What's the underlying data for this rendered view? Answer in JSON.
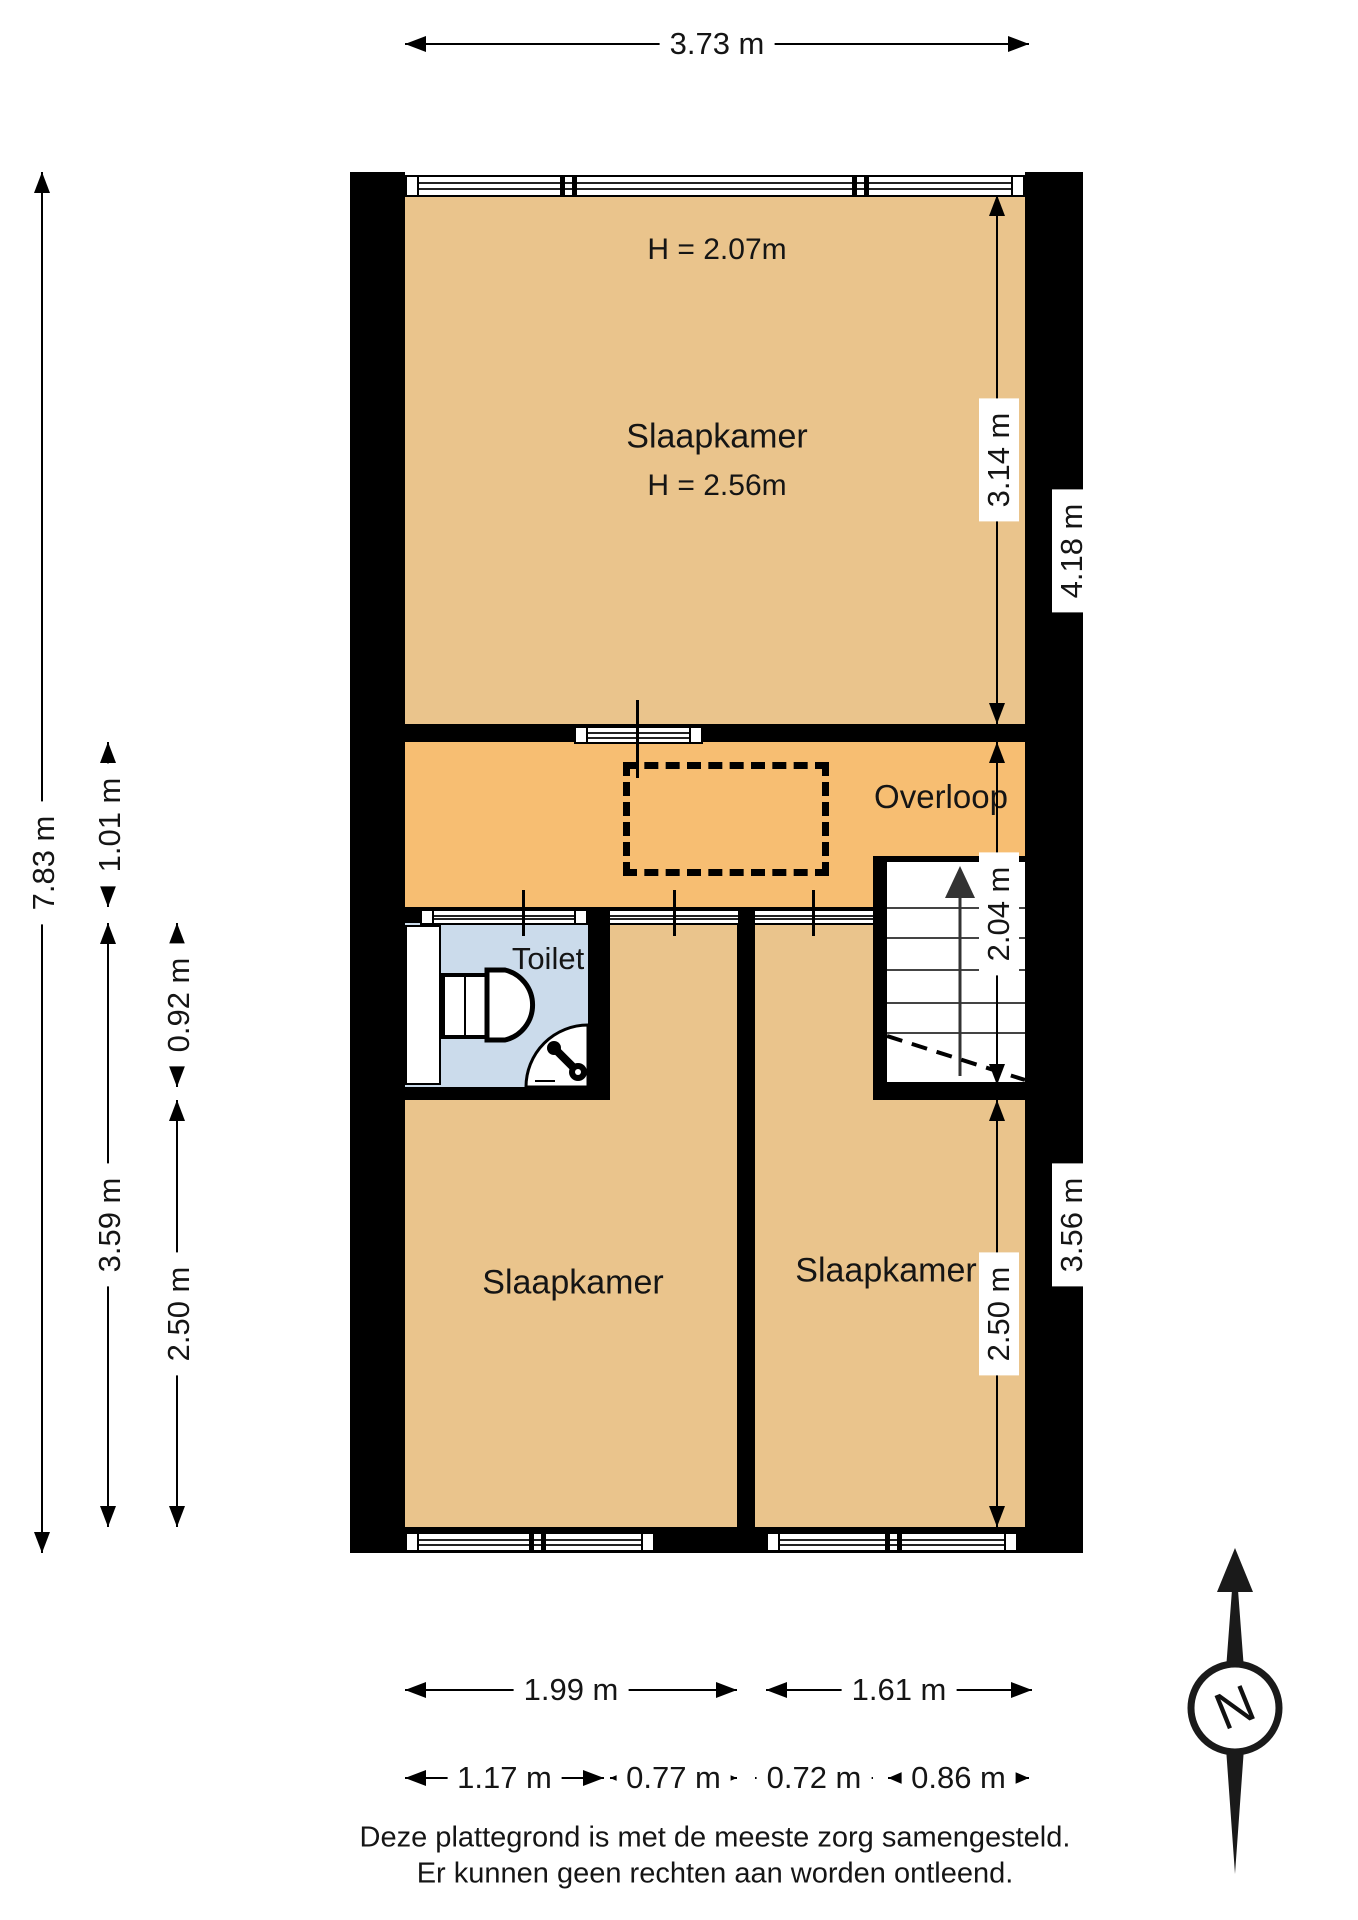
{
  "colors": {
    "room_fill": "#EAC48C",
    "landing_fill": "#F7BE72",
    "toilet_fill": "#CBDBEB",
    "wall": "#000000"
  },
  "rooms": {
    "bedroom_top": {
      "label": "Slaapkamer",
      "ceiling_low": "H = 2.07m",
      "ceiling": "H = 2.56m"
    },
    "landing": {
      "label": "Overloop"
    },
    "toilet": {
      "label": "Toilet"
    },
    "bedroom_left": {
      "label": "Slaapkamer"
    },
    "bedroom_right": {
      "label": "Slaapkamer"
    }
  },
  "dims": {
    "width_total": "3.73 m",
    "height_total": "7.83 m",
    "landing_height": "1.01 m",
    "toilet_height": "0.92 m",
    "left_lower_height": "3.59 m",
    "bedroom_left_height": "2.50 m",
    "bedroom_top_height": "3.14 m",
    "upper_right_height": "4.18 m",
    "stair_zone_height": "2.04 m",
    "bedroom_right_height": "2.50 m",
    "right_lower_height": "3.56 m",
    "bedroom_left_width": "1.99 m",
    "bedroom_right_width": "1.61 m",
    "bottom_w1": "1.17 m",
    "bottom_w2": "0.77 m",
    "bottom_w3": "0.72 m",
    "bottom_w4": "0.86 m"
  },
  "compass": {
    "north_label": "N"
  },
  "footer": {
    "line1": "Deze plattegrond is met de meeste zorg samengesteld.",
    "line2": "Er kunnen geen rechten aan worden ontleend."
  }
}
